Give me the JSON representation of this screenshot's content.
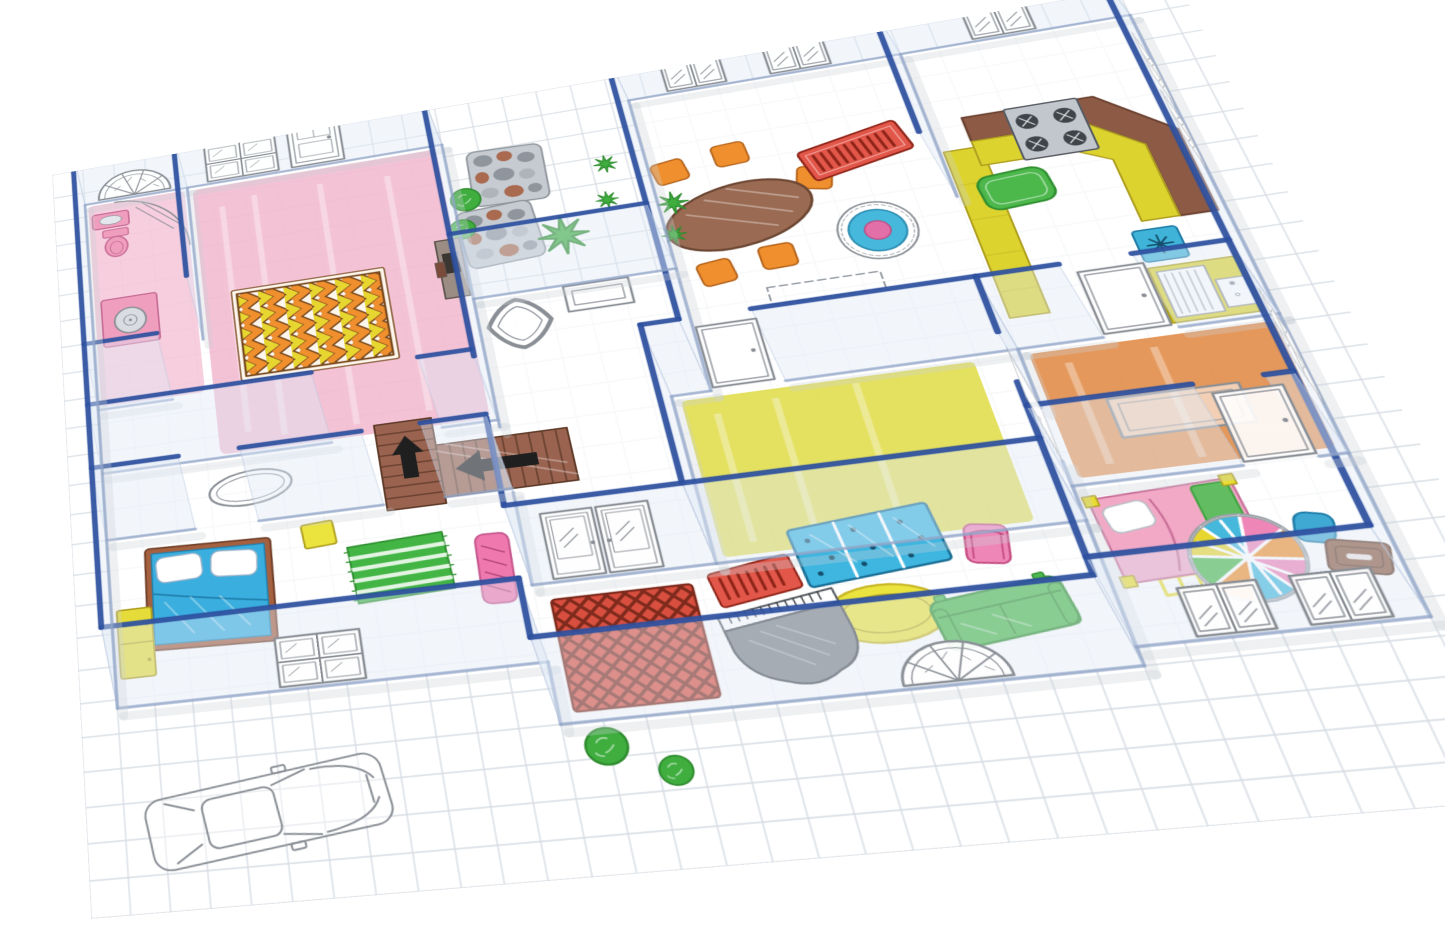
{
  "title": "dollhouse-floor-plan-illustration",
  "scene": {
    "type": "isometric-floor-plan",
    "style": "hand-sketched furniture on grid paper with transparent acrylic walls",
    "rooms": [
      {
        "name": "bathroom",
        "floor_color": "#e9a6bf",
        "items": [
          "corner-shower",
          "toilet",
          "sink",
          "washing-machine",
          "arched-fan-window"
        ]
      },
      {
        "name": "master-bedroom",
        "floor_color": "#ec9dbb",
        "items": [
          "chevron-rug",
          "wall-fireplace",
          "front-door",
          "four-pane-window"
        ]
      },
      {
        "name": "garden-patio",
        "floor_color": "",
        "items": [
          "stone-paver",
          "stone-paver",
          "bush",
          "bush",
          "shrub-starburst",
          "star-plant",
          "star-plant"
        ]
      },
      {
        "name": "hallway",
        "floor_color": "",
        "items": [
          "ornate-mirror",
          "picture-frame",
          "staircase-with-arrows",
          "oval-rug-outline"
        ]
      },
      {
        "name": "dining-room",
        "floor_color": "",
        "items": [
          "oval-table",
          "chair",
          "chair",
          "chair",
          "chair",
          "chair",
          "striped-red-rug",
          "round-target-rug",
          "star-plant",
          "star-plant",
          "sideboard-outline"
        ]
      },
      {
        "name": "kitchen",
        "floor_color": "",
        "items": [
          "l-shaped-counter",
          "stove",
          "green-mat",
          "dish-square",
          "sink-cabinet",
          "long-counter"
        ]
      },
      {
        "name": "study",
        "floor_color": "#e18a44",
        "items": [
          "desk-outline",
          "cabinet-window",
          "door",
          "door"
        ]
      },
      {
        "name": "yellow-room",
        "floor_color": "#ddd838",
        "items": [
          "door",
          "door"
        ]
      },
      {
        "name": "living-room",
        "floor_color": "",
        "items": [
          "grand-piano",
          "green-sofa",
          "pink-armchair",
          "yellow-oval-rug",
          "blue-dotted-rug",
          "red-runner-rug",
          "fan-window"
        ]
      },
      {
        "name": "entry",
        "floor_color": "",
        "items": [
          "woven-red-rug",
          "double-french-doors",
          "bush",
          "bush"
        ]
      },
      {
        "name": "kids-bedroom",
        "floor_color": "",
        "items": [
          "pink-bed",
          "mosaic-round-rug",
          "blue-stool",
          "brown-tray",
          "double-window",
          "double-window"
        ]
      },
      {
        "name": "bedroom-2",
        "floor_color": "",
        "items": [
          "blue-bed",
          "green-striped-rug",
          "yellow-dresser",
          "pink-bench",
          "yellow-nightstand",
          "four-pane-window"
        ]
      },
      {
        "name": "exterior",
        "floor_color": "",
        "items": [
          "car-outline",
          "grid-paper"
        ]
      }
    ]
  },
  "colors": {
    "wallEdge": "#2d4f9e",
    "wallBase": "#8fa3c6",
    "wallFace": "#dfe9f6",
    "grid": "#d6dce3",
    "floor": "#ffffff",
    "sketch": "#8a8f96",
    "pinkFloor": "#ec9dbb",
    "bathPink": "#ef9ebd",
    "bathPinkEdge": "#c76d97",
    "chevronOrange": "#ef8f2d",
    "chevronYellow": "#e7d530",
    "chevronDark": "#7a4a1f",
    "rugRed": "#e2574a",
    "rugRedDark": "#8f2418",
    "targetBlue": "#45b8dc",
    "targetPink": "#e26fa8",
    "tableBrown": "#9a6a52",
    "chairOrange": "#ef8f2d",
    "counterBrown": "#8d5b45",
    "counterYellow": "#ddd32f",
    "stoveGray": "#c2c7cd",
    "burnerDark": "#3f4449",
    "kitchenGreen": "#4cb84c",
    "sinkBlue": "#3fb4d8",
    "orangeFloor": "#e18a44",
    "yellowFloor": "#ddd838",
    "wovenRed": "#d94f3f",
    "wovenDark": "#7e2a1c",
    "pianoGray": "#7b8086",
    "dotBlue": "#3eb6e0",
    "armchairPink": "#ef86b8",
    "ovalYellow": "#ece43e",
    "sofaGreen": "#4db84d",
    "greenDark": "#2f8f2f",
    "bedBlue": "#3aaede",
    "bedFrameBrown": "#a5603f",
    "stripeGreen": "#43b545",
    "dresserYellow": "#e6dc39",
    "benchPink": "#ef79ae",
    "pinkBed": "#f2a9c6",
    "postYellow": "#e8dc35",
    "blanketGreen": "#62bd62",
    "stoolBlue": "#3fa9d4",
    "trayBrown": "#8a5a42",
    "stairBrown": "#9a6350",
    "stairDark": "#5e3a28",
    "arrowBlack": "#1f1f1f",
    "bushGreen": "#3fae3f",
    "bushDark": "#2e8b2e",
    "stoneGray": "#c6cbd1",
    "stoneDark": "#8f959c",
    "stoneBrown": "#a96a4f"
  }
}
